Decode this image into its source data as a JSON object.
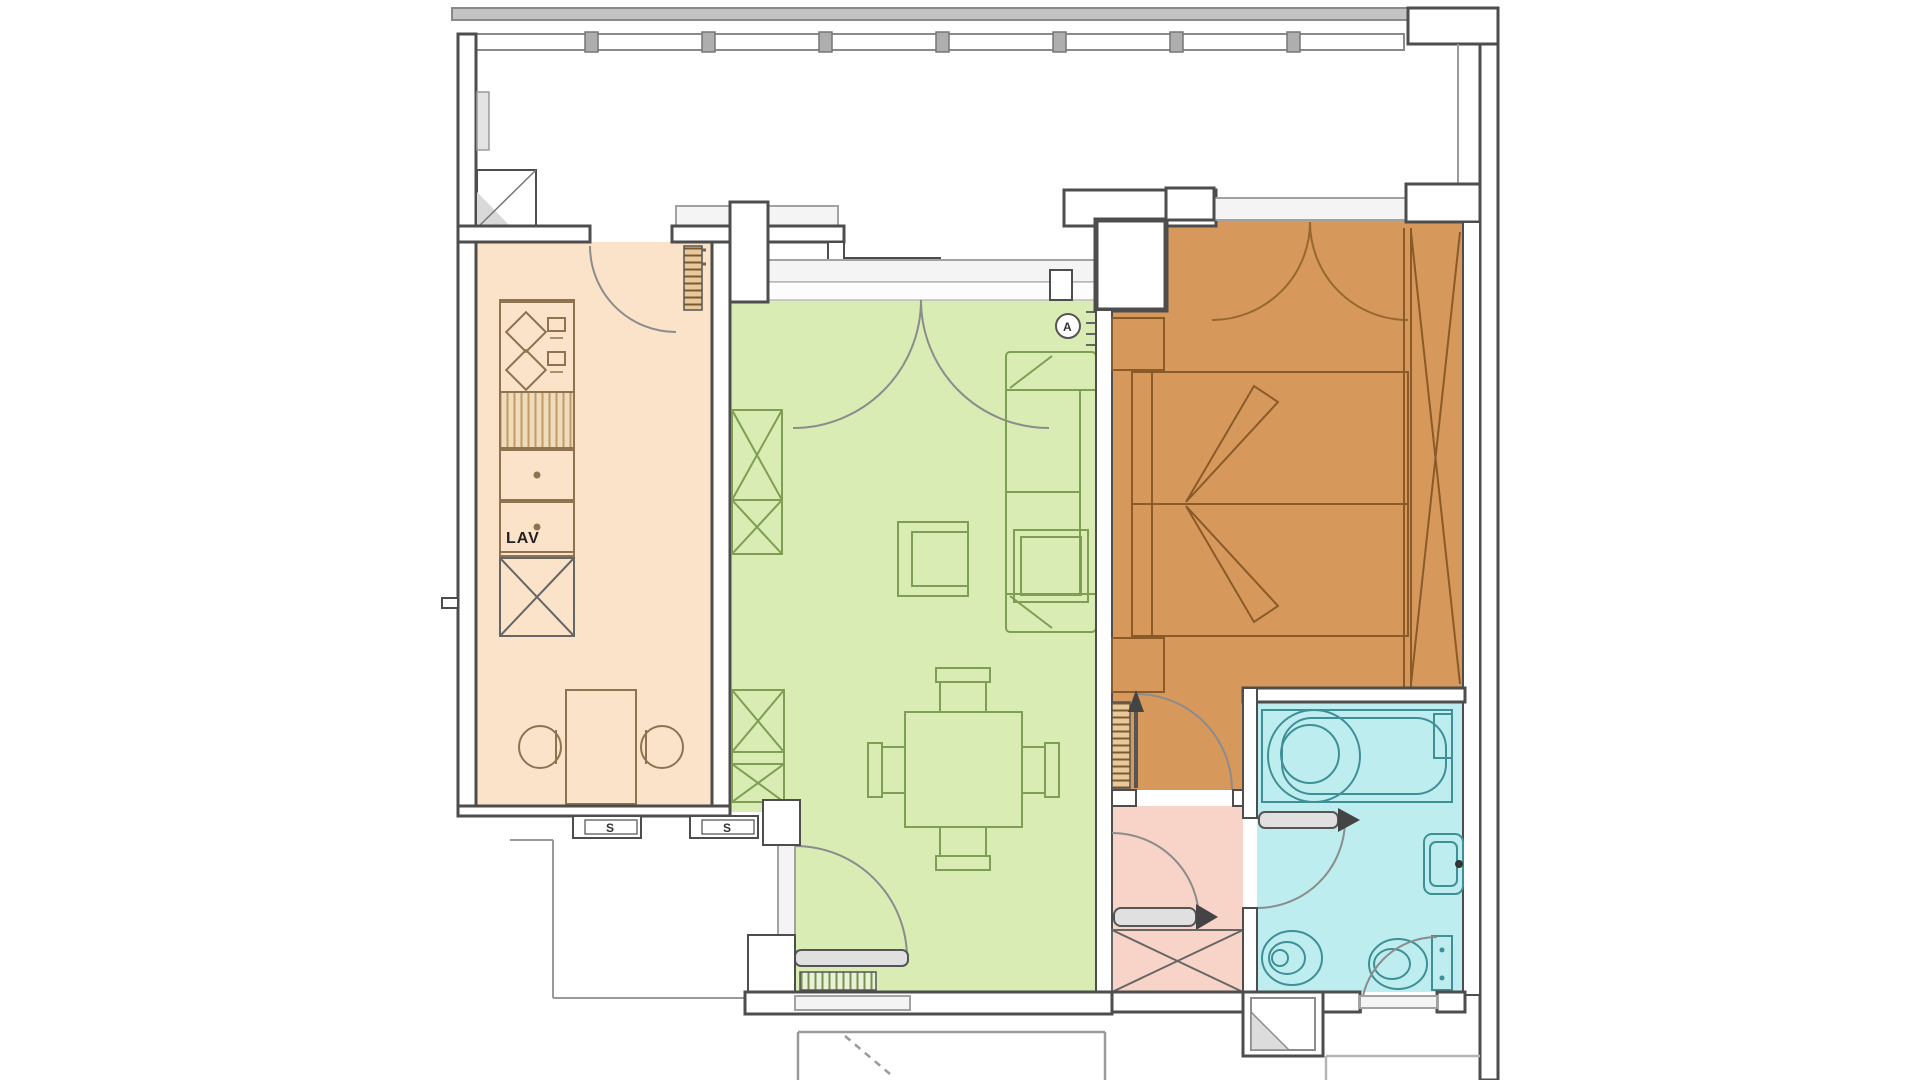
{
  "labels": {
    "sink": "LAV",
    "shutter_left": "S",
    "shutter_right": "S",
    "detector": "A"
  },
  "colors": {
    "kitchen": "#fae3c9",
    "living_room": "#d8ecb4",
    "bedroom": "#d6995b",
    "bathroom": "#beedef",
    "hallway": "#f8d3c7",
    "wall_outline": "#4d4d4d",
    "window_fill": "#f4f4f4",
    "railing": "#c4c4c4",
    "kitchen_furniture": "#8d7350",
    "living_furniture": "#7e9e53",
    "bedroom_furniture": "#8a5a28",
    "bathroom_fixtures": "#3f8f96",
    "door_swing": "#8c8c8c"
  }
}
